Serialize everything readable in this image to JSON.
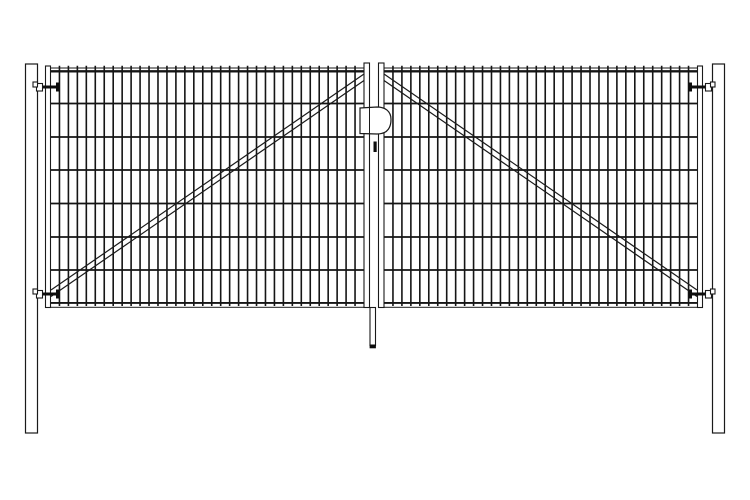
{
  "meta": {
    "subject": "double-wing-mesh-gate-front-elevation",
    "visible_text": []
  },
  "drawing": {
    "canvas": {
      "width": 750,
      "height": 500,
      "background": "#ffffff"
    },
    "colors": {
      "outline": "#1a1a1a",
      "wire": "#151515",
      "fill": "#ffffff",
      "hardware": "#0d0d0d"
    },
    "posts": {
      "left": {
        "x": 25.5,
        "y": 64,
        "width": 12,
        "height": 369
      },
      "right": {
        "x": 712.5,
        "y": 64,
        "width": 12,
        "height": 369
      }
    },
    "leaves": {
      "left": {
        "outer_stile": {
          "x": 45.5,
          "y": 66,
          "width": 5,
          "height": 241.5
        },
        "inner_stile": {
          "x": 364,
          "y": 63,
          "width": 5.5,
          "height": 244.5
        },
        "top_rail": {
          "x": 45.5,
          "y": 68,
          "width": 324,
          "height": 4
        },
        "bottom_rail": {
          "x": 45.5,
          "y": 302.5,
          "width": 324,
          "height": 4.8
        },
        "mesh": {
          "x1": 50.5,
          "x2": 364,
          "y_top": 65.8,
          "y_bottom": 306,
          "vertical_wire_count": 34,
          "horizontal_wire_y": [
            71,
            103.5,
            137,
            170,
            203.5,
            237,
            270,
            303
          ]
        },
        "brace": {
          "x1": 51,
          "y1": 290,
          "x2": 364,
          "y2": 74,
          "pair_offset": 6.5
        }
      },
      "right": {
        "outer_stile": {
          "x": 697.5,
          "y": 66,
          "width": 5,
          "height": 241.5
        },
        "inner_stile": {
          "x": 378.5,
          "y": 63,
          "width": 5.5,
          "height": 244.5
        },
        "top_rail": {
          "x": 378.5,
          "y": 68,
          "width": 324,
          "height": 4
        },
        "bottom_rail": {
          "x": 378.5,
          "y": 302.5,
          "width": 324,
          "height": 4.8
        },
        "mesh": {
          "x1": 384,
          "x2": 697.5,
          "y_top": 65.8,
          "y_bottom": 306,
          "vertical_wire_count": 34,
          "horizontal_wire_y": [
            71,
            103.5,
            137,
            170,
            203.5,
            237,
            270,
            303
          ]
        },
        "brace": {
          "x1": 384,
          "y1": 74,
          "x2": 697,
          "y2": 290,
          "pair_offset": 6.5
        }
      }
    },
    "hinge_geometry": {
      "notch": {
        "dy": -5,
        "h": 5
      },
      "bracket": {
        "dy": -3.5,
        "h": 7.5
      },
      "pin": {
        "dy": -1.5,
        "h": 3
      },
      "cap": {
        "dy": -4.5,
        "h": 9
      }
    },
    "hinge_x": {
      "left": {
        "notch_x": 33,
        "notch_w": 4.5,
        "bracket_x": 36.5,
        "bracket_w": 6,
        "pin_x1": 42.5,
        "pin_x2": 59,
        "cap_x": 56,
        "cap_w": 3.5
      },
      "right": {
        "notch_x": 710.5,
        "notch_w": 4.5,
        "bracket_x": 705.5,
        "bracket_w": 6,
        "pin_x1": 689,
        "pin_x2": 705.5,
        "cap_x": 688.5,
        "cap_w": 3.5
      }
    },
    "hinges": [
      {
        "id": "top-left",
        "side": "left",
        "y_center": 87
      },
      {
        "id": "bottom-left",
        "side": "left",
        "y_center": 294
      },
      {
        "id": "top-right",
        "side": "right",
        "y_center": 87
      },
      {
        "id": "bottom-right",
        "side": "right",
        "y_center": 294
      }
    ],
    "latch": {
      "x": 360,
      "y": 107,
      "width": 31,
      "height": 27.5,
      "plate_line_x": 369.5,
      "keyhole": {
        "x": 373.5,
        "y": 141.5,
        "width": 3.2,
        "height": 10.5
      }
    },
    "drop_rod": {
      "x": 370,
      "y": 307.5,
      "width": 5.5,
      "height": 38,
      "cap": {
        "x": 369.6,
        "y": 344.5,
        "width": 6.3,
        "height": 3.8
      }
    }
  }
}
